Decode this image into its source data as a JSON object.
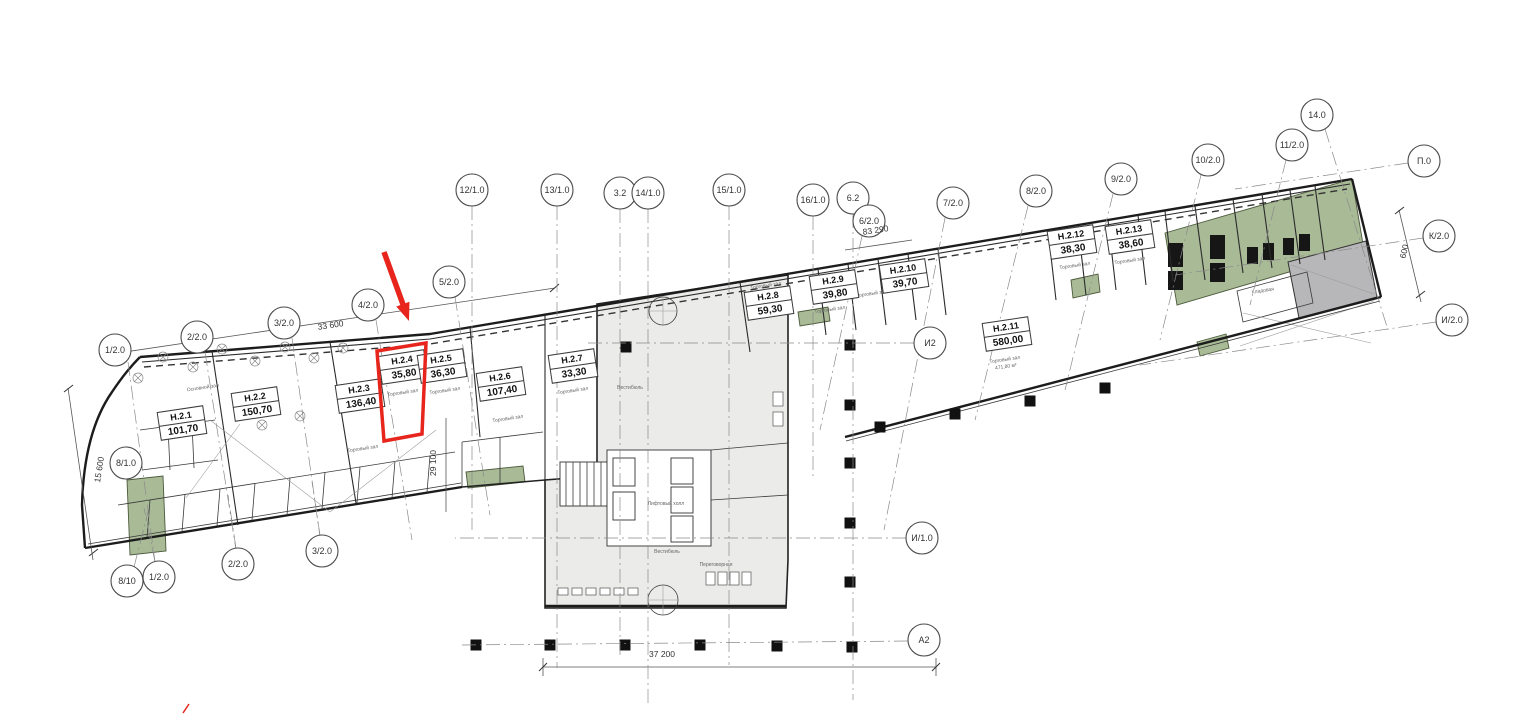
{
  "document": {
    "type": "floor-plan",
    "description": "Этажный план с выделенным помещением Н.2.4"
  },
  "colors": {
    "highlight": "#e8251c",
    "green_room": "#a9ba97",
    "gray_room": "#b7b7b9",
    "core_fill": "#ebebe9",
    "wall": "#1c1c1c"
  },
  "highlight": {
    "unit": "Н.2.4",
    "polygon": [
      [
        377,
        351
      ],
      [
        426,
        343
      ],
      [
        422,
        434
      ],
      [
        384,
        441
      ]
    ],
    "arrow": {
      "x1": 384,
      "y1": 252,
      "x2": 409,
      "y2": 321
    },
    "mark": {
      "x1": 183,
      "y1": 713,
      "x2": 189,
      "y2": 704
    }
  },
  "rooms": [
    {
      "name": "Н.2.1",
      "area": "101,70",
      "x": 182,
      "y": 423
    },
    {
      "name": "Н.2.2",
      "area": "150,70",
      "x": 256,
      "y": 404
    },
    {
      "name": "Н.2.3",
      "area": "136,40",
      "x": 360,
      "y": 396
    },
    {
      "name": "Н.2.4",
      "area": "35,80",
      "x": 403,
      "y": 367,
      "highlight": true
    },
    {
      "name": "Н.2.5",
      "area": "36,30",
      "x": 442,
      "y": 366
    },
    {
      "name": "Н.2.6",
      "area": "107,40",
      "x": 501,
      "y": 384
    },
    {
      "name": "Н.2.7",
      "area": "33,30",
      "x": 573,
      "y": 366
    },
    {
      "name": "Н.2.8",
      "area": "59,30",
      "x": 769,
      "y": 303
    },
    {
      "name": "Н.2.9",
      "area": "39,80",
      "x": 834,
      "y": 287
    },
    {
      "name": "Н.2.10",
      "area": "39,70",
      "x": 904,
      "y": 276
    },
    {
      "name": "Н.2.11",
      "area": "580,00",
      "x": 1007,
      "y": 334
    },
    {
      "name": "Н.2.12",
      "area": "38,30",
      "x": 1072,
      "y": 242
    },
    {
      "name": "Н.2.13",
      "area": "38,60",
      "x": 1130,
      "y": 237
    }
  ],
  "axes": [
    {
      "label": "1/2.0",
      "x": 115,
      "y": 350,
      "line": [
        128,
        362,
        155,
        562
      ]
    },
    {
      "label": "2/2.0",
      "x": 197,
      "y": 337,
      "line": [
        205,
        352,
        236,
        550
      ]
    },
    {
      "label": "3/2.0",
      "x": 284,
      "y": 323,
      "line": [
        292,
        338,
        320,
        537
      ]
    },
    {
      "label": "4/2.0",
      "x": 368,
      "y": 305,
      "line": [
        376,
        320,
        412,
        540
      ]
    },
    {
      "label": "5/2.0",
      "x": 449,
      "y": 282,
      "line": [
        455,
        297,
        490,
        515
      ]
    },
    {
      "label": "12/1.0",
      "x": 472,
      "y": 190,
      "line": [
        472,
        206,
        472,
        530
      ]
    },
    {
      "label": "13/1.0",
      "x": 557,
      "y": 190,
      "line": [
        557,
        206,
        557,
        668
      ]
    },
    {
      "label": "3.2",
      "x": 620,
      "y": 193,
      "line": [
        620,
        209,
        620,
        655
      ]
    },
    {
      "label": "14/1.0",
      "x": 648,
      "y": 193,
      "line": [
        648,
        209,
        648,
        705
      ]
    },
    {
      "label": "15/1.0",
      "x": 729,
      "y": 190,
      "line": [
        729,
        206,
        729,
        665
      ]
    },
    {
      "label": "16/1.0",
      "x": 813,
      "y": 200,
      "line": [
        813,
        216,
        813,
        480
      ]
    },
    {
      "label": "6.2",
      "x": 853,
      "y": 198,
      "line": [
        853,
        214,
        853,
        700
      ]
    },
    {
      "label": "6/2.0",
      "x": 869,
      "y": 221,
      "line": [
        862,
        236,
        820,
        430
      ]
    },
    {
      "label": "7/2.0",
      "x": 953,
      "y": 203,
      "line": [
        945,
        218,
        884,
        530
      ]
    },
    {
      "label": "8/2.0",
      "x": 1036,
      "y": 191,
      "line": [
        1028,
        206,
        975,
        420
      ]
    },
    {
      "label": "9/2.0",
      "x": 1121,
      "y": 179,
      "line": [
        1113,
        194,
        1065,
        390
      ]
    },
    {
      "label": "10/2.0",
      "x": 1208,
      "y": 160,
      "line": [
        1201,
        175,
        1160,
        340
      ]
    },
    {
      "label": "11/2.0",
      "x": 1292,
      "y": 145,
      "line": [
        1286,
        160,
        1250,
        305
      ]
    },
    {
      "label": "14.0",
      "x": 1317,
      "y": 115,
      "line": [
        1325,
        129,
        1388,
        330
      ]
    },
    {
      "label": "П.0",
      "x": 1424,
      "y": 161,
      "line": [
        1408,
        163,
        1235,
        189
      ]
    },
    {
      "label": "К/2.0",
      "x": 1439,
      "y": 236,
      "line": [
        1423,
        238,
        1175,
        275
      ]
    },
    {
      "label": "И/2.0",
      "x": 1452,
      "y": 320,
      "line": [
        1436,
        322,
        1140,
        365
      ]
    },
    {
      "label": "И2",
      "x": 930,
      "y": 343,
      "line": [
        914,
        343,
        585,
        343
      ]
    },
    {
      "label": "И/1.0",
      "x": 922,
      "y": 538,
      "line": [
        906,
        538,
        455,
        538
      ]
    },
    {
      "label": "А2",
      "x": 924,
      "y": 640,
      "line": [
        908,
        641,
        462,
        645
      ]
    },
    {
      "label": "8/10",
      "x": 127,
      "y": 581,
      "line": [
        134,
        567,
        148,
        512
      ]
    },
    {
      "label": "1/2.0",
      "x": 159,
      "y": 577,
      "line": [
        155,
        562,
        144,
        508
      ]
    },
    {
      "label": "2/2.0",
      "x": 238,
      "y": 564,
      "line": [
        236,
        548,
        228,
        495
      ]
    },
    {
      "label": "3/2.0",
      "x": 322,
      "y": 551,
      "line": [
        320,
        535,
        312,
        482
      ]
    },
    {
      "label": "8/1.0",
      "x": 126,
      "y": 463
    }
  ],
  "dimensions": [
    {
      "text": "33 600",
      "x": 331,
      "y": 328,
      "rot": -8.5
    },
    {
      "text": "83 290",
      "x": 876,
      "y": 233,
      "rot": -8.5
    },
    {
      "text": "29 100",
      "x": 436,
      "y": 463,
      "rot": -90
    },
    {
      "text": "15 600",
      "x": 102,
      "y": 470,
      "rot": -81
    },
    {
      "text": "37 200",
      "x": 662,
      "y": 657,
      "rot": 0
    },
    {
      "text": "600",
      "x": 1407,
      "y": 252,
      "rot": -77
    }
  ],
  "sublabels": [
    {
      "text": "Основной зал",
      "x": 203,
      "y": 389,
      "rot": -8.5
    },
    {
      "text": "Торговый зал",
      "x": 363,
      "y": 450,
      "rot": -8.5
    },
    {
      "text": "Торговый зал",
      "x": 403,
      "y": 394,
      "rot": -8.5
    },
    {
      "text": "Торговый зал",
      "x": 445,
      "y": 392,
      "rot": -8.5
    },
    {
      "text": "Торговый зал",
      "x": 508,
      "y": 420,
      "rot": -8.5
    },
    {
      "text": "Торговый зал",
      "x": 573,
      "y": 392,
      "rot": -8.5
    },
    {
      "text": "Торговый зал",
      "x": 766,
      "y": 287,
      "rot": -8.5
    },
    {
      "text": "Торговый зал",
      "x": 830,
      "y": 311,
      "rot": -8.5
    },
    {
      "text": "Торговый зал",
      "x": 872,
      "y": 295,
      "rot": -8.5
    },
    {
      "text": "Торговый зал",
      "x": 1005,
      "y": 361,
      "rot": -8.5
    },
    {
      "text": "471,80 м²",
      "x": 1006,
      "y": 368,
      "rot": -8.5
    },
    {
      "text": "Торговый зал",
      "x": 1075,
      "y": 267,
      "rot": -8.5
    },
    {
      "text": "Торговый зал",
      "x": 1130,
      "y": 262,
      "rot": -8.5
    },
    {
      "text": "Кладовая",
      "x": 1263,
      "y": 292,
      "rot": -8.5
    },
    {
      "text": "Вестибюль",
      "x": 630,
      "y": 389,
      "rot": 0
    },
    {
      "text": "Вестибюль",
      "x": 667,
      "y": 553,
      "rot": 0
    },
    {
      "text": "Лифтовый холл",
      "x": 666,
      "y": 505,
      "rot": 0
    },
    {
      "text": "Переговорная",
      "x": 716,
      "y": 566,
      "rot": 0
    }
  ],
  "columns": [
    [
      476,
      645
    ],
    [
      550,
      645
    ],
    [
      625,
      645
    ],
    [
      700,
      645
    ],
    [
      777,
      646
    ],
    [
      852,
      647
    ],
    [
      928,
      648
    ],
    [
      850,
      345
    ],
    [
      850,
      405
    ],
    [
      850,
      463
    ],
    [
      850,
      523
    ],
    [
      850,
      582
    ],
    [
      626,
      347
    ],
    [
      880,
      427
    ],
    [
      955,
      414
    ],
    [
      1030,
      401
    ],
    [
      1105,
      388
    ]
  ],
  "table_symbols": [
    [
      138,
      378
    ],
    [
      163,
      357
    ],
    [
      193,
      367
    ],
    [
      222,
      349
    ],
    [
      255,
      361
    ],
    [
      285,
      347
    ],
    [
      314,
      358
    ],
    [
      343,
      348
    ],
    [
      262,
      425
    ],
    [
      300,
      416
    ]
  ]
}
